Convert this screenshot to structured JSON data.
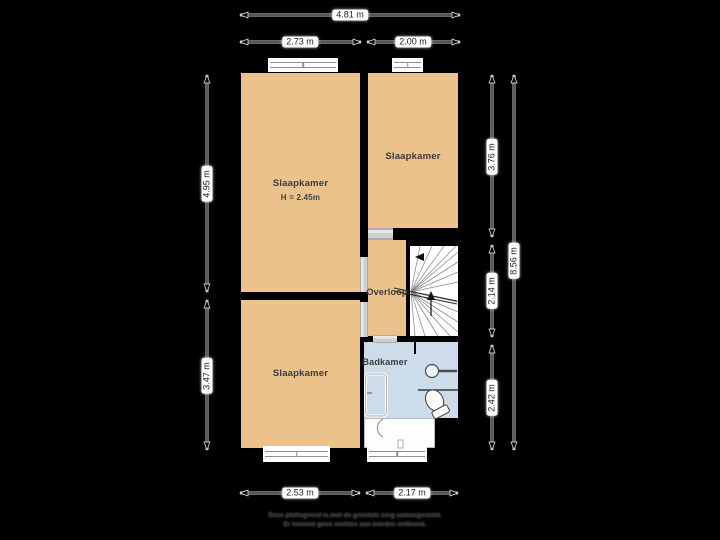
{
  "floorplan": {
    "rooms": {
      "bedroom_left": {
        "label": "Slaapkamer",
        "height_note": "H = 2.45m"
      },
      "bedroom_right": {
        "label": "Slaapkamer"
      },
      "bedroom_bottom": {
        "label": "Slaapkamer"
      },
      "landing": {
        "label": "Overloop"
      },
      "bathroom": {
        "label": "Badkamer"
      }
    },
    "dimensions": {
      "top_total": "4.81 m",
      "top_left": "2.73 m",
      "top_right": "2.00 m",
      "left_upper": "4.95 m",
      "left_lower": "3.47 m",
      "right_upper": "3.76 m",
      "right_middle": "2.14 m",
      "right_lower": "2.42 m",
      "right_total": "8.56 m",
      "bottom_left": "2.53 m",
      "bottom_right": "2.17 m"
    },
    "colors": {
      "background": "#000000",
      "wall": "#000000",
      "room_fill": "#ebc28b",
      "bathroom_fill": "#cddcea",
      "stairs_fill": "#ffffff",
      "dimension_label_bg": "#ffffff",
      "dimension_label_text": "#1f1f1f"
    },
    "fixtures": [
      "staircase",
      "shower",
      "sink",
      "toilet"
    ],
    "disclaimer": {
      "line1": "Deze plattegrond is met de grootste zorg samengesteld.",
      "line2": "Er kunnen geen rechten aan worden ontleend."
    }
  }
}
